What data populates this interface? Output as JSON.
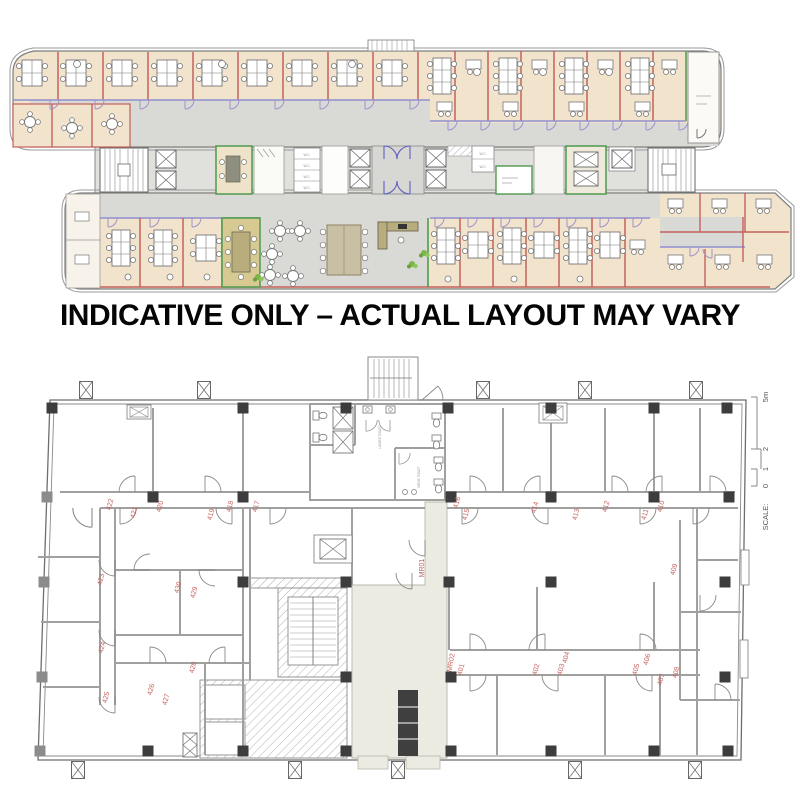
{
  "banner": {
    "text": "INDICATIVE ONLY – ACTUAL LAYOUT MAY VARY"
  },
  "plan_top": {
    "description": "indicative office fit-out plan",
    "wc_labels": [
      "W.C.",
      "W.C.",
      "W.C.",
      "W.C.",
      "W.C.",
      "W.C."
    ],
    "colors": {
      "office_fill": "#f2e3cd",
      "corridor": "#d9d9d5",
      "wall_red": "#c4615c",
      "wall_blue": "#8f8fd0",
      "wall_green": "#4e9a4e",
      "meeting_fill": "#d6c992",
      "door_purple": "#9f93cc",
      "plant_green": "#7ab648"
    }
  },
  "plan_bottom": {
    "description": "base building floor plan",
    "rooms": [
      "401",
      "402",
      "403",
      "404",
      "405",
      "406",
      "407",
      "408",
      "409",
      "410",
      "411",
      "412",
      "413",
      "414",
      "415",
      "416",
      "417",
      "418",
      "419",
      "420",
      "421",
      "422",
      "423",
      "424",
      "425",
      "426",
      "427",
      "428",
      "429",
      "430"
    ],
    "meeting_rooms": [
      "MR01",
      "MR02"
    ],
    "toilet_labels": [
      "LADIES TOILET",
      "MENS TOILET"
    ],
    "scale": {
      "label": "SCALE:",
      "ticks": [
        "0",
        "1",
        "2"
      ],
      "max": "5m"
    },
    "label_color": "#c4615c"
  }
}
